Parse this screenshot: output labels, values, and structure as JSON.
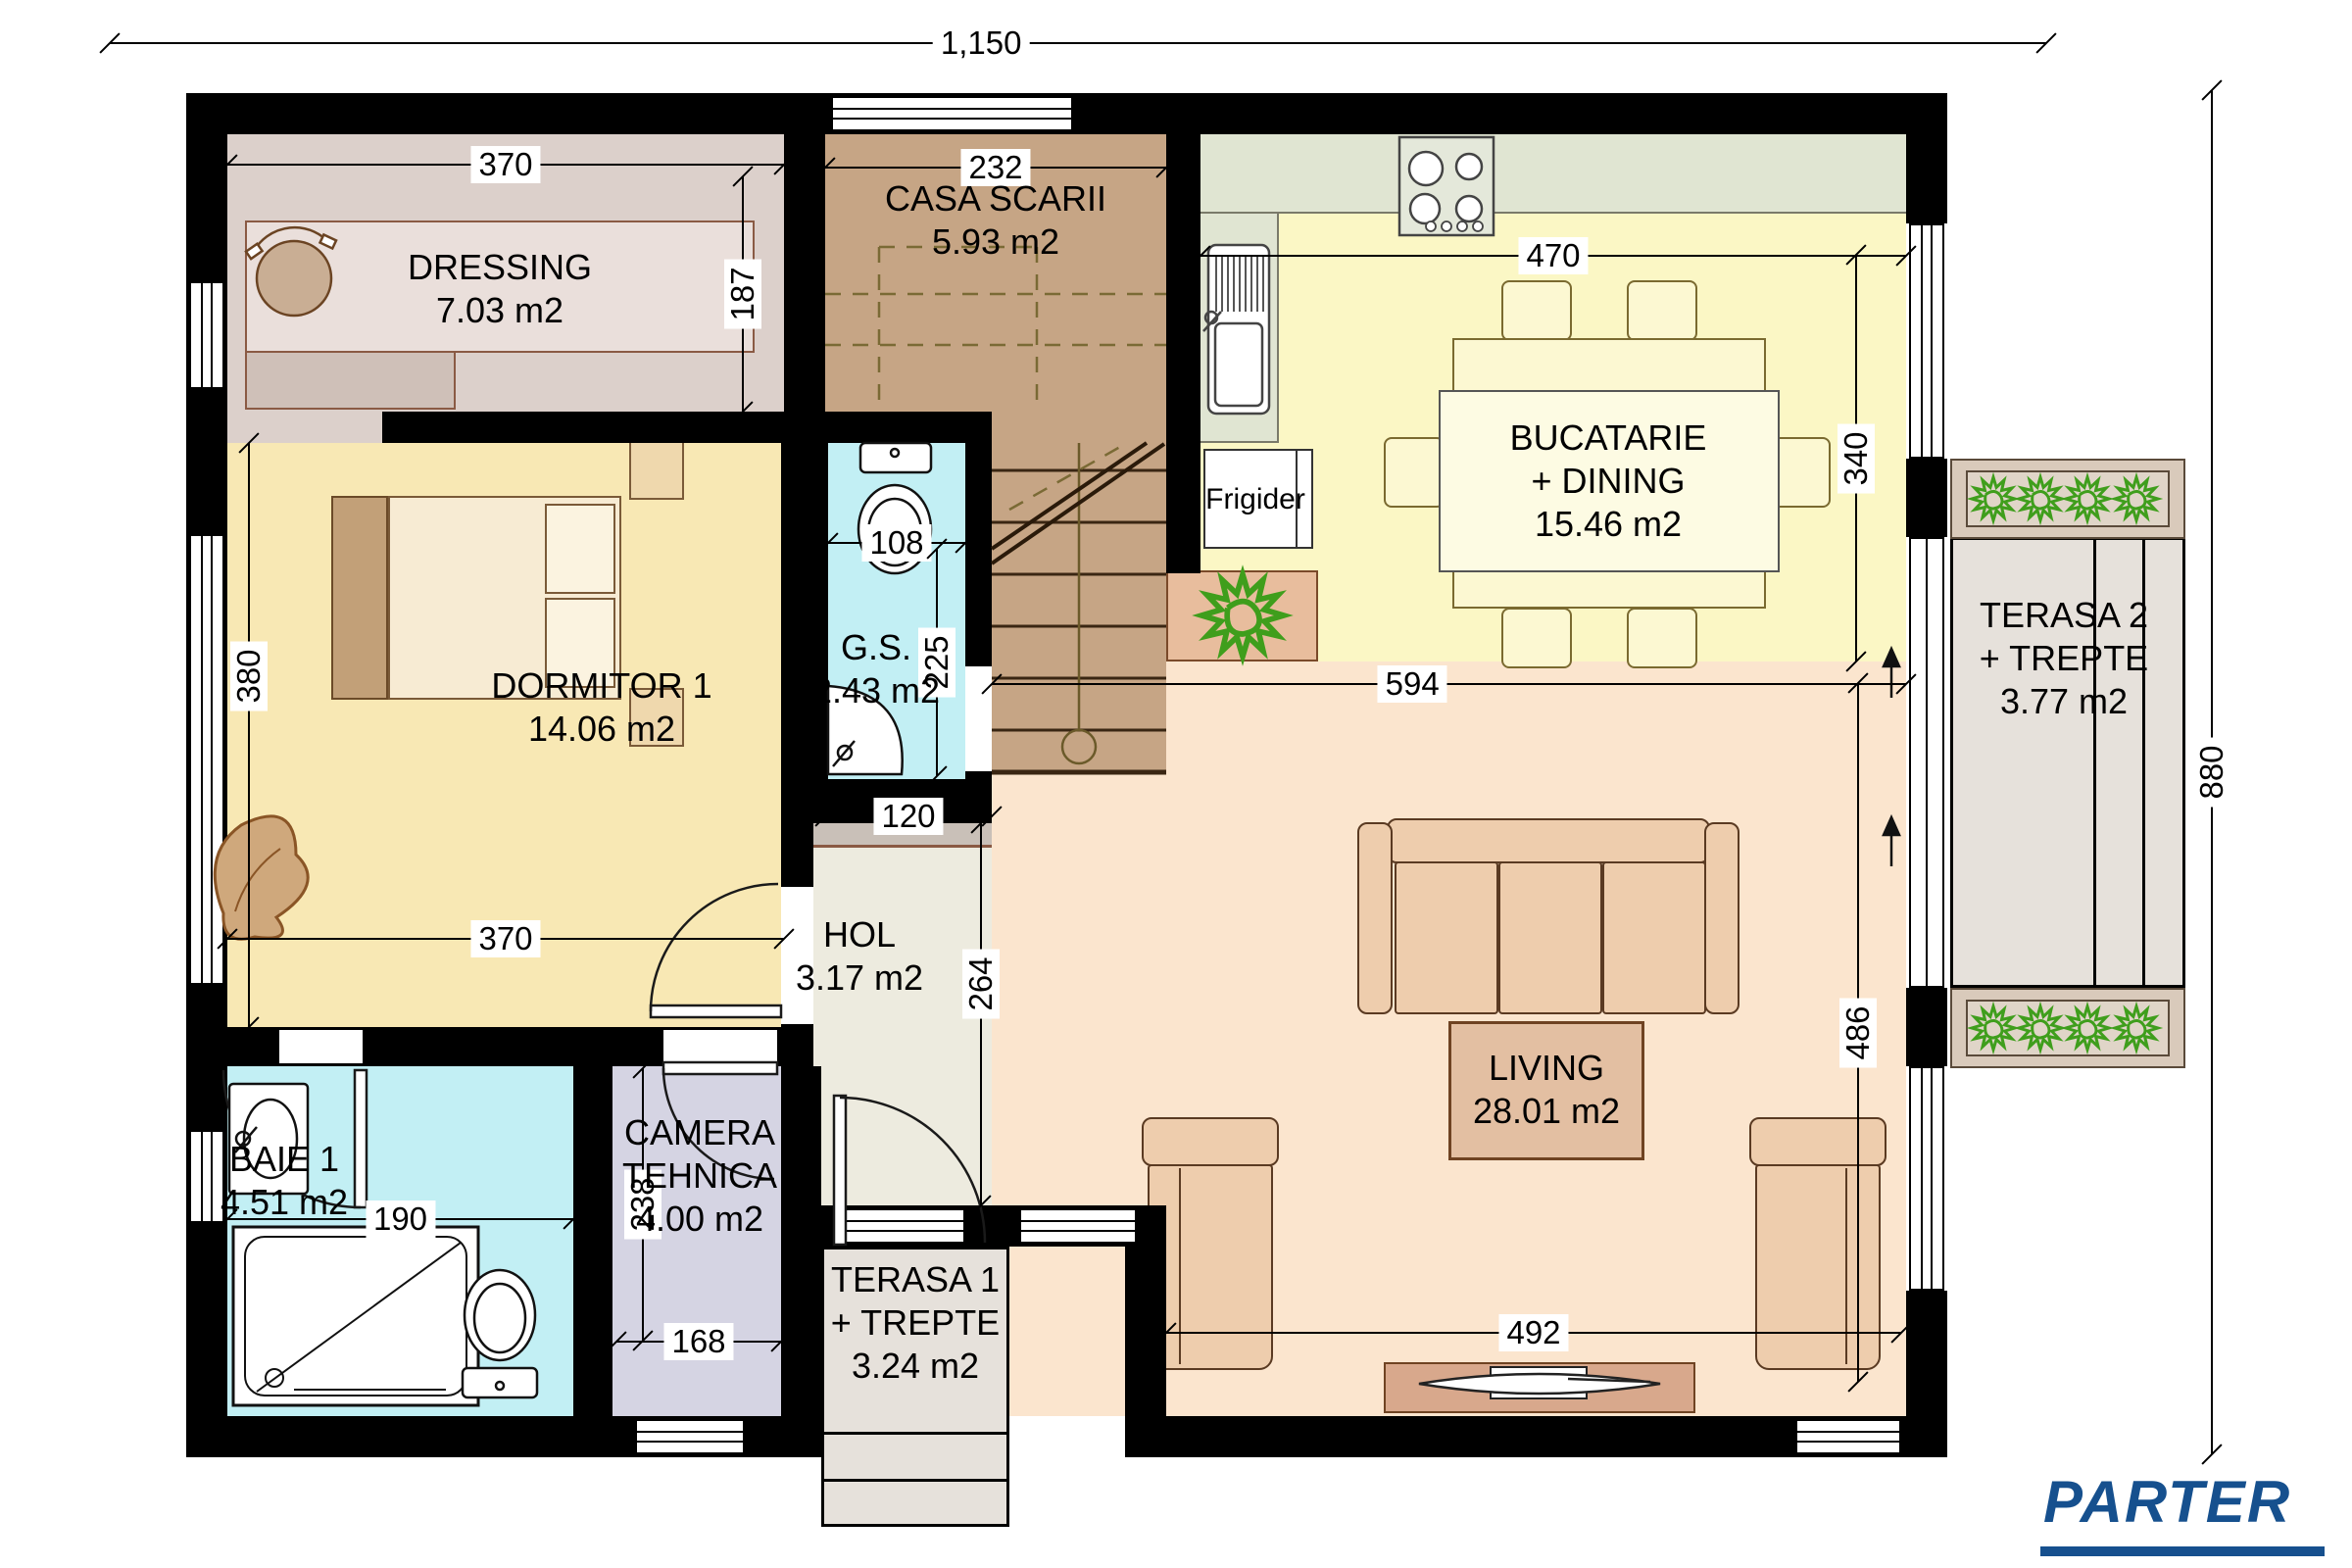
{
  "title": {
    "text": "PARTER"
  },
  "rooms": {
    "dressing": {
      "label": "DRESSING",
      "area": "7.03 m2"
    },
    "casa_scarii": {
      "label": "CASA SCARII",
      "area": "5.93 m2"
    },
    "bucatarie": {
      "l1": "BUCATARIE",
      "l2": "+ DINING",
      "area": "15.46 m2"
    },
    "dormitor1": {
      "label": "DORMITOR 1",
      "area": "14.06 m2"
    },
    "gs": {
      "label": "G.S.",
      "area": "2.43 m2"
    },
    "hol": {
      "label": "HOL",
      "area": "3.17 m2"
    },
    "living": {
      "label": "LIVING",
      "area": "28.01 m2"
    },
    "baie1": {
      "label": "BAIE 1",
      "area": "4.51 m2"
    },
    "camera_tehnica": {
      "l1": "CAMERA",
      "l2": "TEHNICA",
      "area": "4.00 m2"
    },
    "terasa1": {
      "l1": "TERASA 1",
      "l2": "+ TREPTE",
      "area": "3.24 m2"
    },
    "terasa2": {
      "l1": "TERASA 2",
      "l2": "+ TREPTE",
      "area": "3.77 m2"
    }
  },
  "appliances": {
    "fridge": "Frigider"
  },
  "dimensions": {
    "total_width": "1,150",
    "total_height": "880",
    "dressing_width": "370",
    "dressing_depth": "187",
    "stairwell_width": "232",
    "kitchen_width": "470",
    "kitchen_depth": "340",
    "gs_width": "108",
    "gs_depth": "225",
    "bedroom_depth": "380",
    "bedroom_width": "370",
    "hall_niche_width": "120",
    "hall_depth": "264",
    "living_width_top": "594",
    "living_depth": "486",
    "living_width_bottom": "492",
    "bath_width": "190",
    "tech_room_depth": "238",
    "tech_room_width": "168"
  },
  "colors": {
    "accent": "#16508e",
    "wall": "#000000",
    "bedroom_floor": "#f8e8b4",
    "kitchen_floor": "#fbf7c5",
    "living_floor": "#fbe5ce",
    "bath_floor": "#c2eff4",
    "stair_floor": "#c6a585",
    "dressing_floor": "#dcd0cb",
    "tech_floor": "#d5d4e3",
    "hall_floor": "#edebdf",
    "terrace_floor": "#e6e1db",
    "plant_green": "#3f9e1c"
  }
}
